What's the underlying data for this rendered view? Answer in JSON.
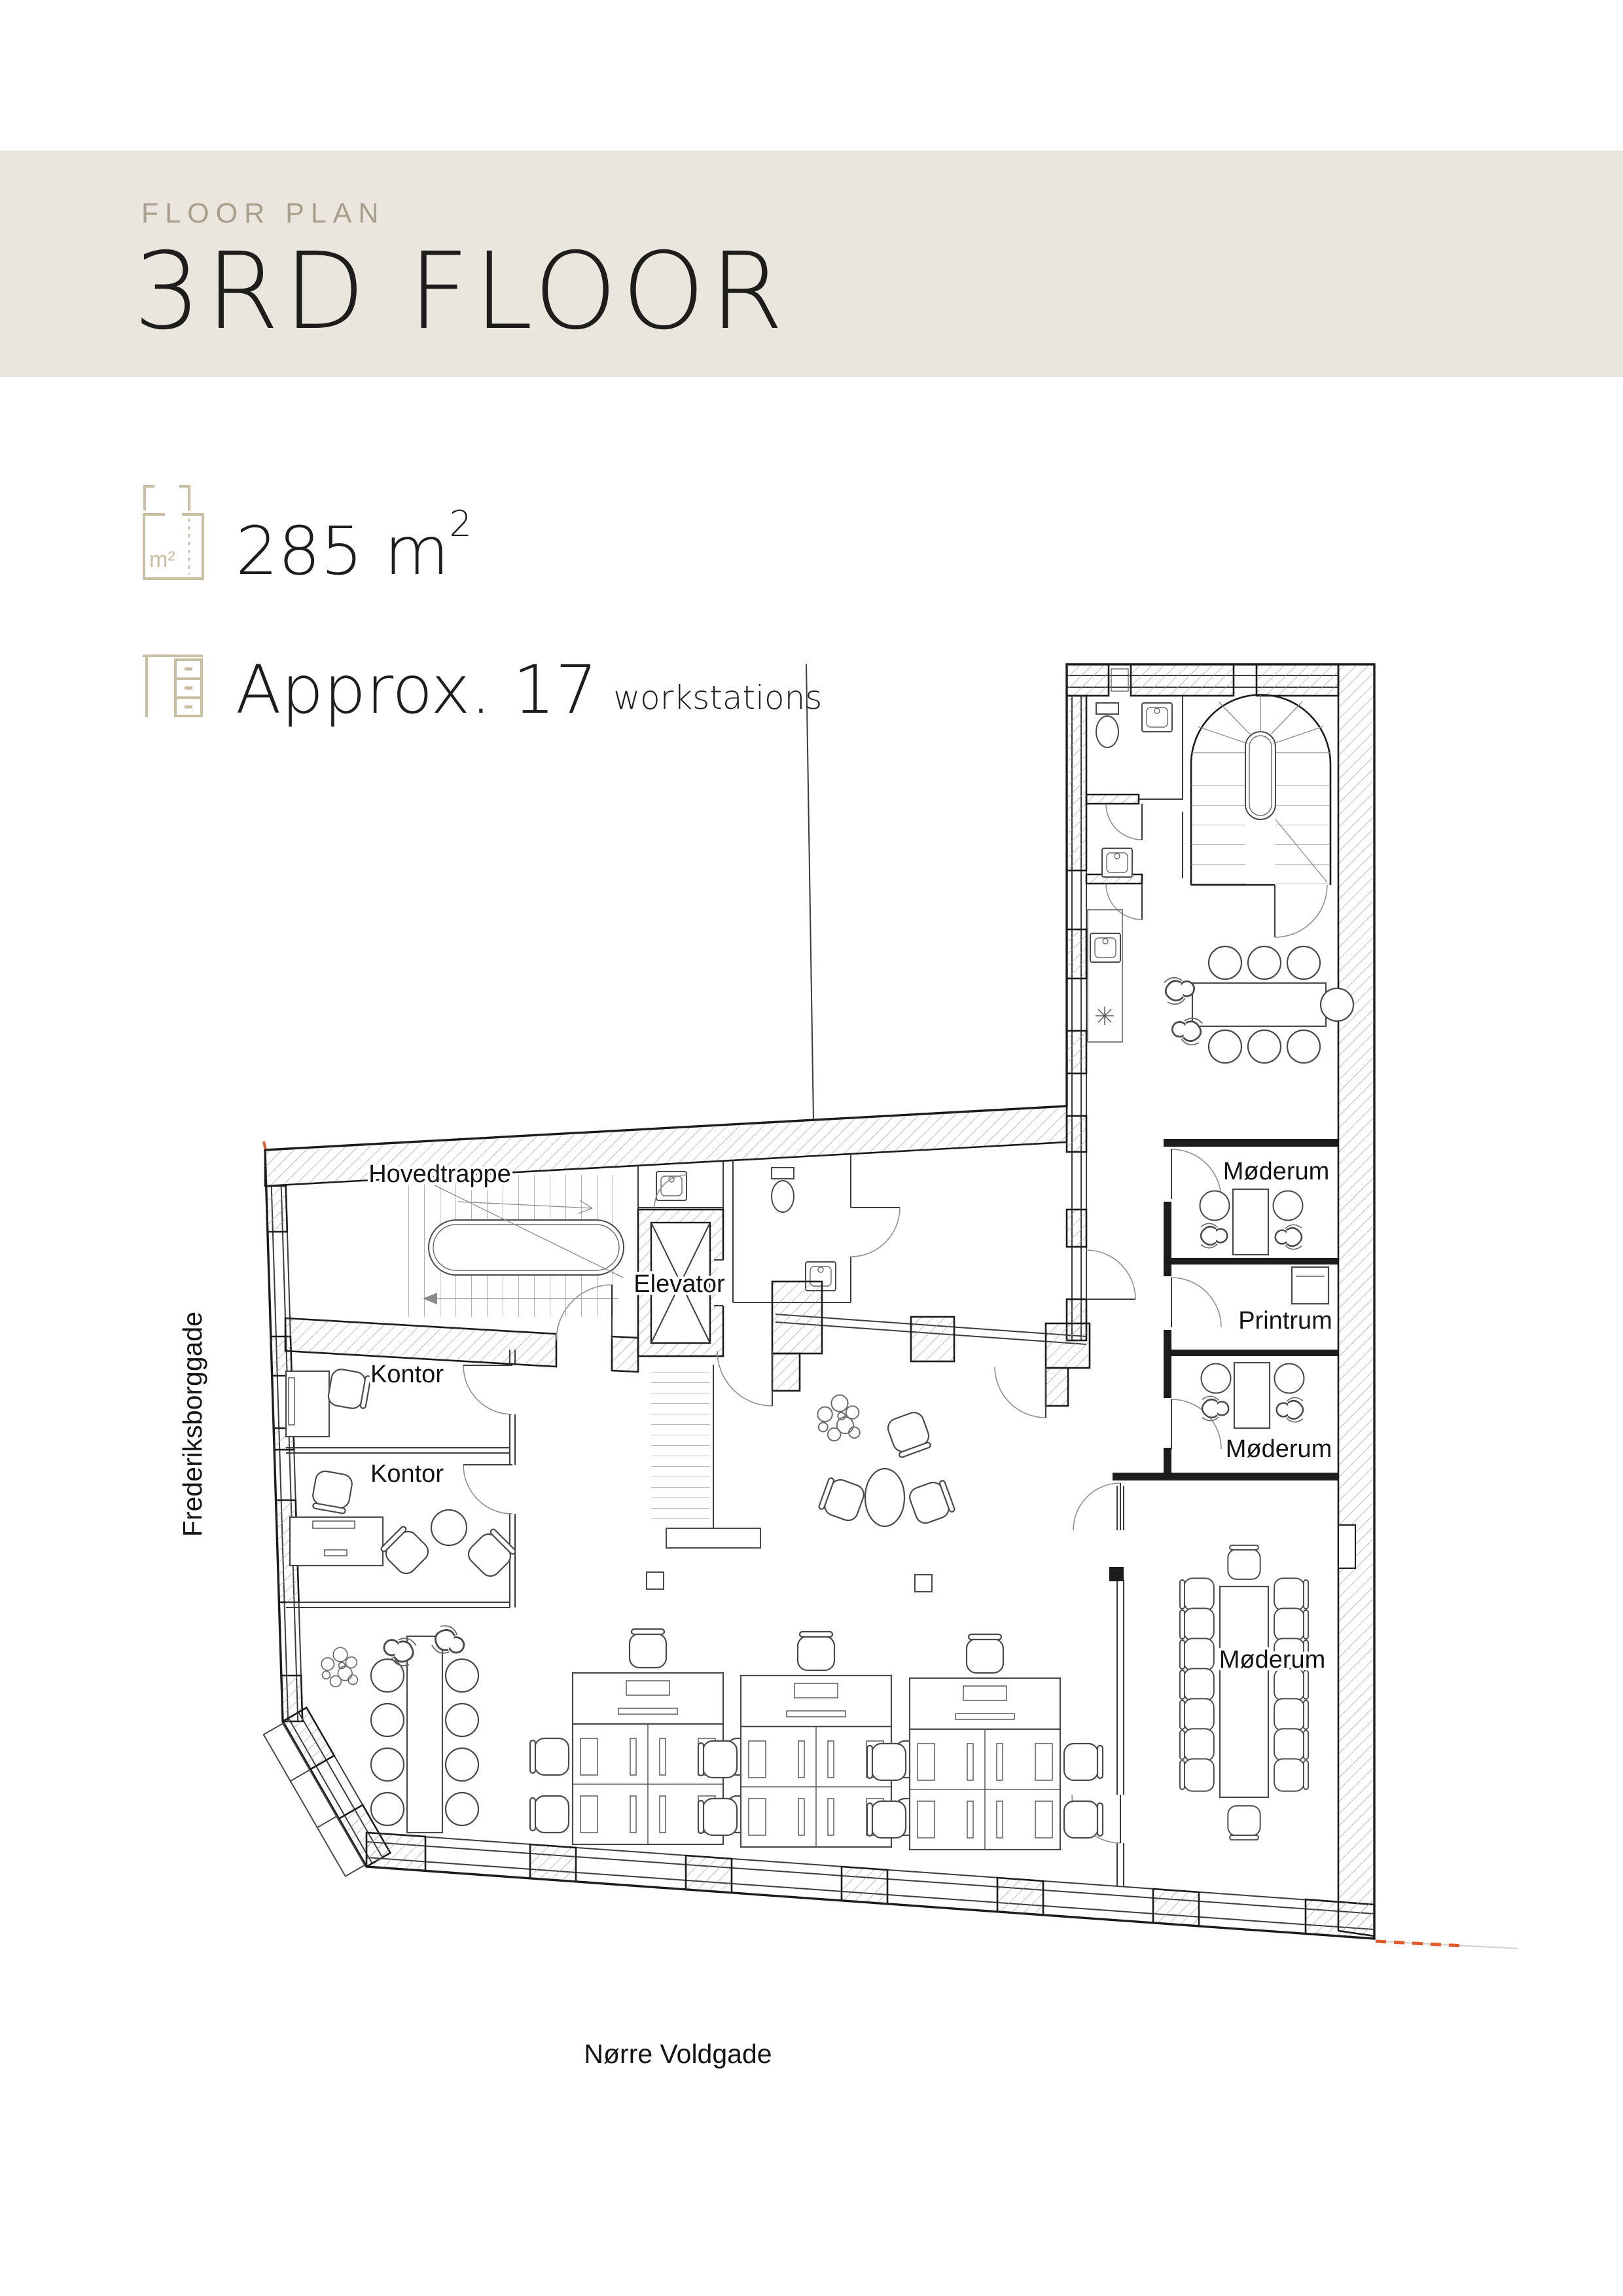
{
  "page": {
    "background": "#ffffff"
  },
  "header": {
    "eyebrow": "FLOOR PLAN",
    "title": "3RD FLOOR",
    "band_color": "#EAE6DE",
    "eyebrow_color": "#A79E8B",
    "title_color": "#1D1D1B"
  },
  "facts": {
    "icon_color": "#C9BDA2",
    "area": {
      "value": "285 m",
      "sup": "2",
      "icon": "area-plan-icon"
    },
    "capacity": {
      "main": "Approx. 17",
      "suffix": "workstations",
      "icon": "desk-icon"
    }
  },
  "plan": {
    "line_color": "#1C1C1C",
    "accent_dashed_color": "#E2592B",
    "rooms": {
      "hovedtrappe": {
        "label": "Hovedtrappe"
      },
      "elevator": {
        "label": "Elevator"
      },
      "kontor_upper": {
        "label": "Kontor"
      },
      "kontor_lower": {
        "label": "Kontor"
      },
      "moederum_north": {
        "label": "Møderum"
      },
      "printrum": {
        "label": "Printrum"
      },
      "moederum_middle": {
        "label": "Møderum"
      },
      "moederum_large": {
        "label": "Møderum"
      }
    },
    "streets": {
      "west": {
        "label": "Frederiksborggade"
      },
      "south": {
        "label": "Nørre Voldgade"
      }
    }
  }
}
